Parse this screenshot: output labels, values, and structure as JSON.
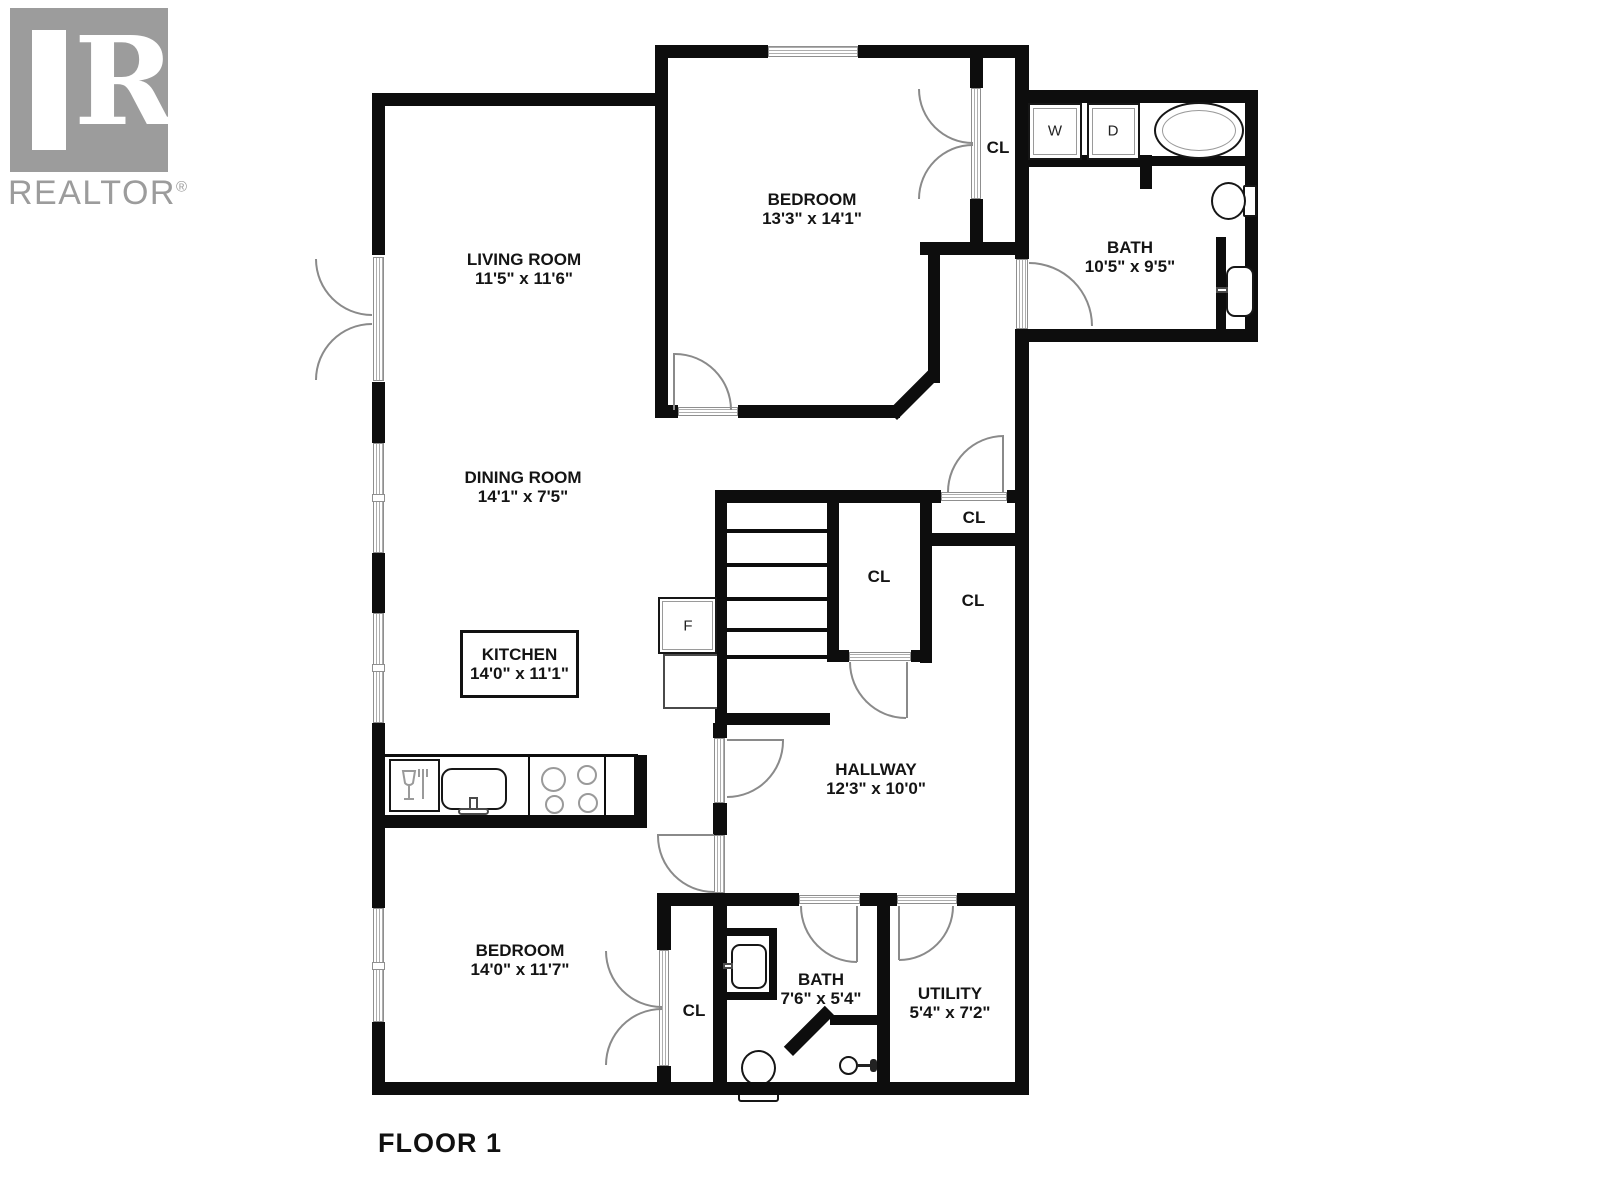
{
  "logo": {
    "brand": "REALTOR",
    "registered": "®",
    "r_letter": "R"
  },
  "floor_label": "FLOOR 1",
  "rooms": [
    {
      "name": "LIVING ROOM",
      "dims": "11'5\" x 11'6\""
    },
    {
      "name": "DINING ROOM",
      "dims": "14'1\" x 7'5\""
    },
    {
      "name": "KITCHEN",
      "dims": "14'0\" x 11'1\""
    },
    {
      "name": "BEDROOM",
      "dims": "13'3\" x 14'1\""
    },
    {
      "name": "BATH",
      "dims": "10'5\" x 9'5\""
    },
    {
      "name": "HALLWAY",
      "dims": "12'3\" x 10'0\""
    },
    {
      "name": "BEDROOM",
      "dims": "14'0\" x 11'7\""
    },
    {
      "name": "BATH",
      "dims": "7'6\" x 5'4\""
    },
    {
      "name": "UTILITY",
      "dims": "5'4\" x 7'2\""
    }
  ],
  "closet_label": "CL",
  "appliances": {
    "washer": "W",
    "dryer": "D",
    "fridge": "F"
  },
  "colors": {
    "wall": "#0d0d0d",
    "logo_gray": "#9c9c9c",
    "fixture_line": "#8a8a8a"
  }
}
